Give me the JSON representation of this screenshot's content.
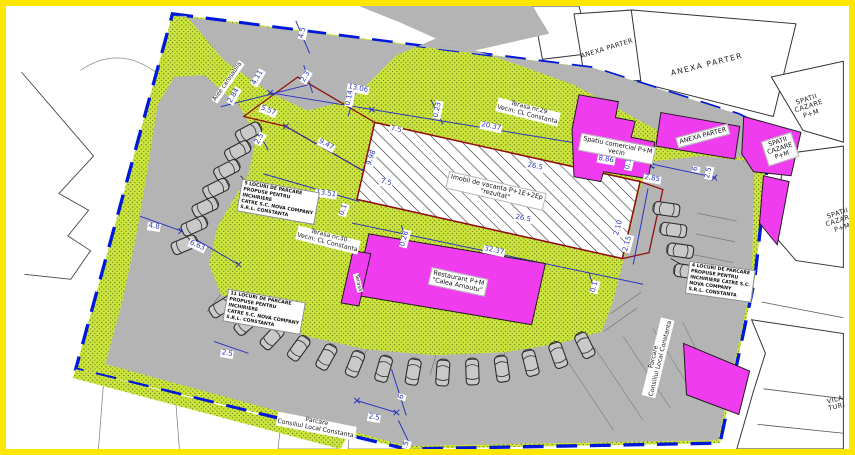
{
  "plan": {
    "colors": {
      "frame_yellow": "#ffe600",
      "site_green": "#cde63e",
      "road_gray": "#b4b4b4",
      "building_magenta": "#ef3cee",
      "boundary_blue": "#0018d8",
      "dimension_blue": "#2a35c0",
      "cadastral_red": "#8f1010"
    },
    "dimension_labels": [
      {
        "name": "dim-4_5-top",
        "text": "4.5",
        "x": 297,
        "y": 27,
        "r": -78
      },
      {
        "name": "dim-2_84",
        "text": "2.84",
        "x": 228,
        "y": 90,
        "r": -60
      },
      {
        "name": "dim-4_11",
        "text": "4.11",
        "x": 252,
        "y": 72,
        "r": -60
      },
      {
        "name": "dim-2_3",
        "text": "2.3",
        "x": 300,
        "y": 71,
        "r": -60
      },
      {
        "name": "dim-5_57",
        "text": "5.57",
        "x": 262,
        "y": 105,
        "r": 22
      },
      {
        "name": "dim-13_06",
        "text": "13.06",
        "x": 352,
        "y": 83,
        "r": 11
      },
      {
        "name": "dim-0_14",
        "text": "0.14",
        "x": 344,
        "y": 92,
        "r": -78
      },
      {
        "name": "dim-20_37",
        "text": "20.37",
        "x": 485,
        "y": 121,
        "r": 12
      },
      {
        "name": "dim-0_23",
        "text": "0.23",
        "x": 432,
        "y": 104,
        "r": -78
      },
      {
        "name": "dim-7_5-a",
        "text": "7.5",
        "x": 390,
        "y": 124,
        "r": 12
      },
      {
        "name": "dim-9_98",
        "text": "9.98",
        "x": 366,
        "y": 152,
        "r": -70
      },
      {
        "name": "dim-7_5-b",
        "text": "7.5",
        "x": 380,
        "y": 177,
        "r": 12
      },
      {
        "name": "dim-9_47",
        "text": "9.47",
        "x": 320,
        "y": 139,
        "r": 28
      },
      {
        "name": "dim-26_5-a",
        "text": "26.5",
        "x": 529,
        "y": 161,
        "r": 12
      },
      {
        "name": "dim-8_86",
        "text": "8.86",
        "x": 600,
        "y": 154,
        "r": 10
      },
      {
        "name": "dim-0_1-a",
        "text": "0.1",
        "x": 623,
        "y": 158,
        "r": -78
      },
      {
        "name": "dim-2_85",
        "text": "2.85",
        "x": 646,
        "y": 173,
        "r": 10
      },
      {
        "name": "dim-6-right",
        "text": "6",
        "x": 690,
        "y": 163,
        "r": -78
      },
      {
        "name": "dim-2_5-right",
        "text": "2.5",
        "x": 703,
        "y": 167,
        "r": -78
      },
      {
        "name": "dim-13_51",
        "text": "13.51",
        "x": 320,
        "y": 188,
        "r": 8
      },
      {
        "name": "dim-0_1-mid",
        "text": "0.1",
        "x": 338,
        "y": 204,
        "r": -70
      },
      {
        "name": "dim-26_5-b",
        "text": "26.5",
        "x": 517,
        "y": 213,
        "r": 12
      },
      {
        "name": "dim-2_10",
        "text": "2.10",
        "x": 613,
        "y": 222,
        "r": -75
      },
      {
        "name": "dim-2_15",
        "text": "2.15",
        "x": 622,
        "y": 238,
        "r": -75
      },
      {
        "name": "dim-32_37",
        "text": "32.37",
        "x": 488,
        "y": 245,
        "r": 12
      },
      {
        "name": "dim-0_28",
        "text": "0.28",
        "x": 399,
        "y": 233,
        "r": -75
      },
      {
        "name": "dim-4_8",
        "text": "4.8",
        "x": 148,
        "y": 221,
        "r": 8
      },
      {
        "name": "dim-6_63",
        "text": "6.63",
        "x": 191,
        "y": 240,
        "r": 24
      },
      {
        "name": "dim-3",
        "text": "3",
        "x": 290,
        "y": 204,
        "r": -60
      },
      {
        "name": "dim-2_5-leftcol",
        "text": "2.5",
        "x": 254,
        "y": 133,
        "r": -60
      },
      {
        "name": "dim-2_5-bottomleft",
        "text": "2.5",
        "x": 221,
        "y": 348,
        "r": 10
      },
      {
        "name": "dim-2_5-bottommid",
        "text": "2.5",
        "x": 368,
        "y": 412,
        "r": 10
      },
      {
        "name": "dim-6-bottom",
        "text": "6",
        "x": 396,
        "y": 391,
        "r": -72
      },
      {
        "name": "dim-4_5-bottom",
        "text": "4.5",
        "x": 400,
        "y": 441,
        "r": -72
      },
      {
        "name": "dim-0_1-b",
        "text": "0.1",
        "x": 589,
        "y": 281,
        "r": -75
      }
    ],
    "parking_notes": [
      {
        "name": "note-5-locuri",
        "x": 272,
        "y": 196,
        "r": 10,
        "text": "5 LOCURI DE PARCARE\nPROPUSE PENTRU\nINCHIRIERE\nCATRE S.C. NOVA COMPANY\nS.R.L. CONSTANTA"
      },
      {
        "name": "note-11-locuri",
        "x": 258,
        "y": 306,
        "r": 10,
        "text": "11 LOCURI DE PARCARE\nPROPUSE PENTRU\nINCHIRIERE\nCATRE S.C. NOVA COMPANY\nS.R.L. CONSTANTA"
      },
      {
        "name": "note-4-locuri",
        "x": 714,
        "y": 276,
        "r": 8,
        "text": "4 LOCURI DE PARCARE\nPROPUSE PENTRU\nINCHIRIERE CATRE S.C.\nNOVA COMPANY\nS.R.L. CONSTANTA"
      }
    ],
    "building_labels": [
      {
        "name": "label-imobil-vacanta",
        "cls": "bldg",
        "x": 490,
        "y": 185,
        "r": 13,
        "text": "Imobil de vacanta P+1E+2Ep\n\"rezultat\""
      },
      {
        "name": "label-restaurant",
        "cls": "bldg",
        "x": 452,
        "y": 276,
        "r": 12,
        "text": "Restaurant P+M\n\"Calea Arnautu\""
      },
      {
        "name": "label-spatiu-comercial",
        "cls": "bldg",
        "x": 611,
        "y": 143,
        "r": 11,
        "text": "Spatiu comercial P+M\nvecin"
      },
      {
        "name": "label-anexa-parter-magenta",
        "cls": "bldg",
        "x": 697,
        "y": 130,
        "r": -15,
        "text": "ANEXA PARTER"
      },
      {
        "name": "label-spatii-cazare-magenta",
        "cls": "bldg",
        "x": 774,
        "y": 143,
        "r": -18,
        "text": "SPATII\nCAZARE\nP+M"
      },
      {
        "name": "label-terasa-strip",
        "cls": "tinyv",
        "x": 352,
        "y": 277,
        "r": 76,
        "text": "Terasa"
      }
    ],
    "neighbor_labels": [
      {
        "name": "label-anexa-parter-1",
        "cls": "areaSm",
        "x": 601,
        "y": 43,
        "r": -17,
        "text": "ANEXA PARTER"
      },
      {
        "name": "label-anexa-parter-2",
        "cls": "area",
        "x": 701,
        "y": 59,
        "r": -14,
        "text": "ANEXA PARTER"
      },
      {
        "name": "label-spatii-cazare-1",
        "cls": "areaSm",
        "x": 803,
        "y": 101,
        "r": -18,
        "text": "SPATII\nCAZARE\nP+M"
      },
      {
        "name": "label-spatii-cazare-2",
        "cls": "areaSm",
        "x": 834,
        "y": 215,
        "r": -18,
        "text": "SPATII\nCAZARE\nP+M"
      },
      {
        "name": "label-vila-turistica",
        "cls": "areaSm",
        "x": 830,
        "y": 398,
        "r": -14,
        "text": "VILA TURI"
      },
      {
        "name": "label-terasa-29",
        "cls": "vec",
        "x": 522,
        "y": 106,
        "r": 14,
        "text": "Terasa nr.29\nVecin: CL Constanta"
      },
      {
        "name": "label-terasa-30",
        "cls": "vec",
        "x": 322,
        "y": 234,
        "r": 14,
        "text": "Terasa nr.30\nVecin: CL Constanta"
      },
      {
        "name": "label-alee-carosabila",
        "cls": "road",
        "x": 222,
        "y": 76,
        "r": -55,
        "text": "Alee carosabila"
      },
      {
        "name": "label-parcare-bottom",
        "cls": "vec",
        "x": 310,
        "y": 420,
        "r": 11,
        "text": "Parcare\nConsiliul Local Constanta"
      },
      {
        "name": "label-parcare-right",
        "cls": "vec",
        "x": 652,
        "y": 352,
        "r": -76,
        "text": "Parcare\nConsiliul Local Constanta"
      }
    ],
    "parking_rows": [
      {
        "name": "parking-row-left",
        "cars": [
          [
            240,
            128,
            62
          ],
          [
            229,
            147,
            62
          ],
          [
            218,
            166,
            63
          ],
          [
            207,
            185,
            64
          ],
          [
            196,
            204,
            65
          ],
          [
            185,
            223,
            66
          ],
          [
            175,
            242,
            67
          ]
        ]
      },
      {
        "name": "parking-row-bottom",
        "cars": [
          [
            213,
            305,
            58
          ],
          [
            238,
            322,
            50
          ],
          [
            264,
            336,
            43
          ],
          [
            291,
            347,
            36
          ],
          [
            319,
            356,
            29
          ],
          [
            348,
            363,
            22
          ],
          [
            377,
            368,
            16
          ],
          [
            407,
            371,
            10
          ],
          [
            437,
            372,
            4
          ],
          [
            467,
            371,
            -2
          ],
          [
            497,
            368,
            -8
          ],
          [
            526,
            362,
            -14
          ],
          [
            554,
            354,
            -20
          ],
          [
            581,
            344,
            -26
          ]
        ]
      },
      {
        "name": "parking-row-right",
        "cars": [
          [
            664,
            206,
            -82
          ],
          [
            671,
            227,
            -82
          ],
          [
            678,
            248,
            -82
          ],
          [
            685,
            269,
            -82
          ]
        ]
      }
    ]
  }
}
